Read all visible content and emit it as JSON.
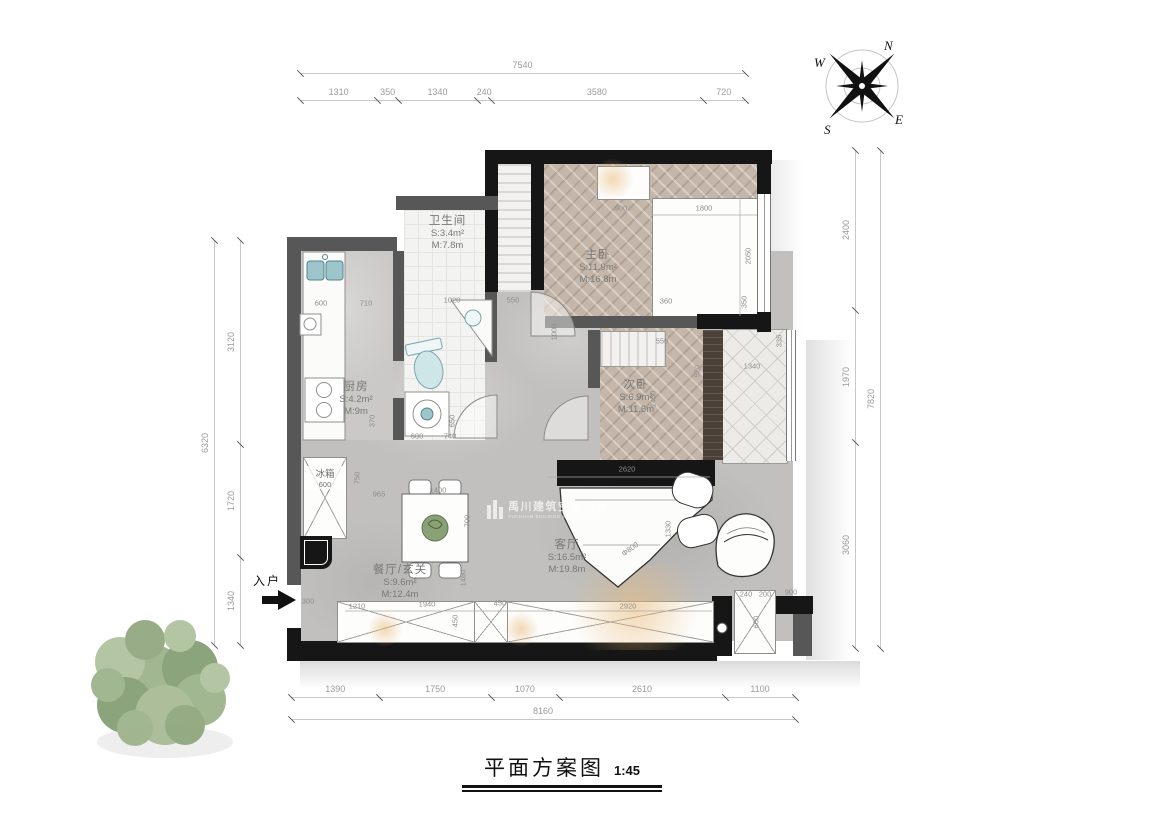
{
  "title": {
    "text": "平面方案图",
    "scale": "1:45"
  },
  "compass": {
    "n": "N",
    "e": "E",
    "s": "S",
    "w": "W"
  },
  "watermark": {
    "cn": "禹川建筑空间设计",
    "en": "YUCHUAN BUILDING SPACE DESIGN"
  },
  "entrance_label": "入户",
  "rooms": {
    "bathroom": {
      "name": "卫生间",
      "s": "S:3.4m²",
      "m": "M:7.8m"
    },
    "master": {
      "name": "主卧",
      "s": "S:11.9m²",
      "m": "M:16.8m"
    },
    "second": {
      "name": "次卧",
      "s": "S:6.9m²",
      "m": "M:11.6m"
    },
    "kitchen": {
      "name": "厨房",
      "s": "S:4.2m²",
      "m": "M:9m"
    },
    "living": {
      "name": "客厅",
      "s": "S:16.5m²",
      "m": "M:19.8m"
    },
    "dining": {
      "name": "餐厅/玄关",
      "s": "S:9.6m²",
      "m": "M:12.4m"
    },
    "fridge": {
      "name": "冰箱",
      "size": "600"
    }
  },
  "dimensions": {
    "top": {
      "total": "7540",
      "segments": [
        "1310",
        "350",
        "1340",
        "240",
        "3580",
        "720"
      ]
    },
    "bottom": {
      "total": "8160",
      "segments": [
        "1390",
        "1750",
        "1070",
        "2610",
        "1100"
      ]
    },
    "left": {
      "total": "6320",
      "segments": [
        "3120",
        "1720",
        "1340"
      ]
    },
    "right": {
      "total": "7820",
      "segments": [
        "2400",
        "1970",
        "3060"
      ]
    },
    "interior": [
      {
        "t": "600",
        "x": 321,
        "y": 303
      },
      {
        "t": "710",
        "x": 366,
        "y": 303
      },
      {
        "t": "1020",
        "x": 452,
        "y": 300
      },
      {
        "t": "550",
        "x": 513,
        "y": 300
      },
      {
        "t": "1000",
        "x": 554,
        "y": 332,
        "r": -90
      },
      {
        "t": "900",
        "x": 621,
        "y": 208
      },
      {
        "t": "1800",
        "x": 704,
        "y": 208
      },
      {
        "t": "2050",
        "x": 748,
        "y": 256,
        "r": -90
      },
      {
        "t": "360",
        "x": 666,
        "y": 301
      },
      {
        "t": "350",
        "x": 744,
        "y": 302,
        "r": -90
      },
      {
        "t": "550",
        "x": 662,
        "y": 341
      },
      {
        "t": "520",
        "x": 697,
        "y": 371,
        "r": -90
      },
      {
        "t": "1340",
        "x": 752,
        "y": 366
      },
      {
        "t": "335",
        "x": 779,
        "y": 341,
        "r": -90
      },
      {
        "t": "1450",
        "x": 653,
        "y": 399,
        "r": -90
      },
      {
        "t": "370",
        "x": 372,
        "y": 421,
        "r": -90
      },
      {
        "t": "650",
        "x": 452,
        "y": 421,
        "r": -90
      },
      {
        "t": "600",
        "x": 417,
        "y": 436
      },
      {
        "t": "740",
        "x": 450,
        "y": 436
      },
      {
        "t": "750",
        "x": 357,
        "y": 478,
        "r": -90
      },
      {
        "t": "965",
        "x": 379,
        "y": 494
      },
      {
        "t": "1400",
        "x": 438,
        "y": 490
      },
      {
        "t": "700",
        "x": 467,
        "y": 521,
        "r": -90
      },
      {
        "t": "2620",
        "x": 627,
        "y": 469
      },
      {
        "t": "1330",
        "x": 668,
        "y": 529,
        "r": -90
      },
      {
        "t": "Φ800",
        "x": 630,
        "y": 549,
        "r": -35
      },
      {
        "t": "1460",
        "x": 463,
        "y": 578,
        "r": -90
      },
      {
        "t": "300",
        "x": 308,
        "y": 601
      },
      {
        "t": "1210",
        "x": 357,
        "y": 606
      },
      {
        "t": "1940",
        "x": 427,
        "y": 604
      },
      {
        "t": "450",
        "x": 500,
        "y": 603
      },
      {
        "t": "450",
        "x": 455,
        "y": 621,
        "r": -90
      },
      {
        "t": "2920",
        "x": 628,
        "y": 606
      },
      {
        "t": "240",
        "x": 746,
        "y": 594
      },
      {
        "t": "200",
        "x": 765,
        "y": 594
      },
      {
        "t": "900",
        "x": 791,
        "y": 592
      },
      {
        "t": "600",
        "x": 756,
        "y": 622,
        "r": -90
      }
    ]
  },
  "colors": {
    "wall_black": "#161616",
    "wall_gray": "#575757",
    "floor_marble": "#c1c0be",
    "wood": "#c4b6a9",
    "fixture_teal": "#9cc5cc",
    "glow": "#e7b978",
    "tree_green": "#93a981"
  }
}
